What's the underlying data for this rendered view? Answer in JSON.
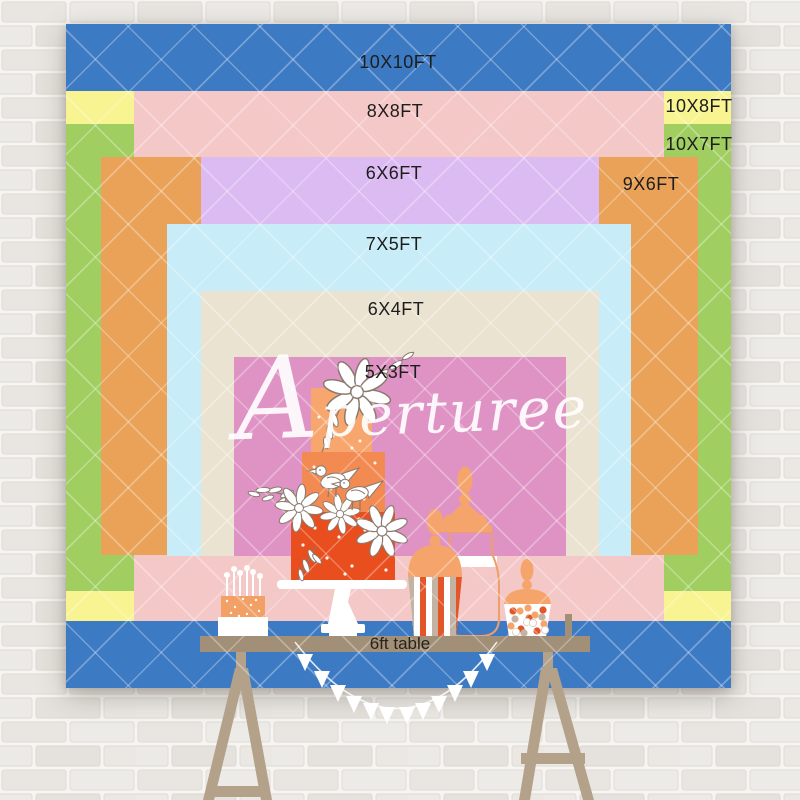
{
  "product": {
    "watermark": "Aperturee"
  },
  "size_chart": {
    "labels": {
      "s10x10": "10X10FT",
      "s8x8": "8X8FT",
      "s10x8": "10X8FT",
      "s6x6": "6X6FT",
      "s10x7": "10X7FT",
      "s7x5": "7X5FT",
      "s9x6": "9X6FT",
      "s6x4": "6X4FT",
      "s5x3": "5X3FT"
    }
  },
  "table": {
    "label": "6ft table"
  },
  "colors": {
    "size_10x10": "#3d7ac4",
    "size_10x8": "#f9f492",
    "size_10x7": "#a0ce60",
    "size_8x8": "#f5c8c8",
    "size_9x6": "#e9a257",
    "size_6x6": "#dcbaf2",
    "size_7x5": "#c8edf9",
    "size_6x4": "#ebe3d2",
    "size_5x3": "#df93c4",
    "table_top": "#a28f77",
    "table_legs": "#b3a189",
    "cake_tier_top": "#f7a76e",
    "cake_tier_middle": "#f28a52",
    "cake_tier_bottom": "#e84e1e",
    "small_cake": "#f3a066",
    "accent_peach": "#f5a56c",
    "accent_red": "#e2562a",
    "accent_taupe": "#c4b3a2",
    "outline_orange": "#ec9f6b"
  }
}
